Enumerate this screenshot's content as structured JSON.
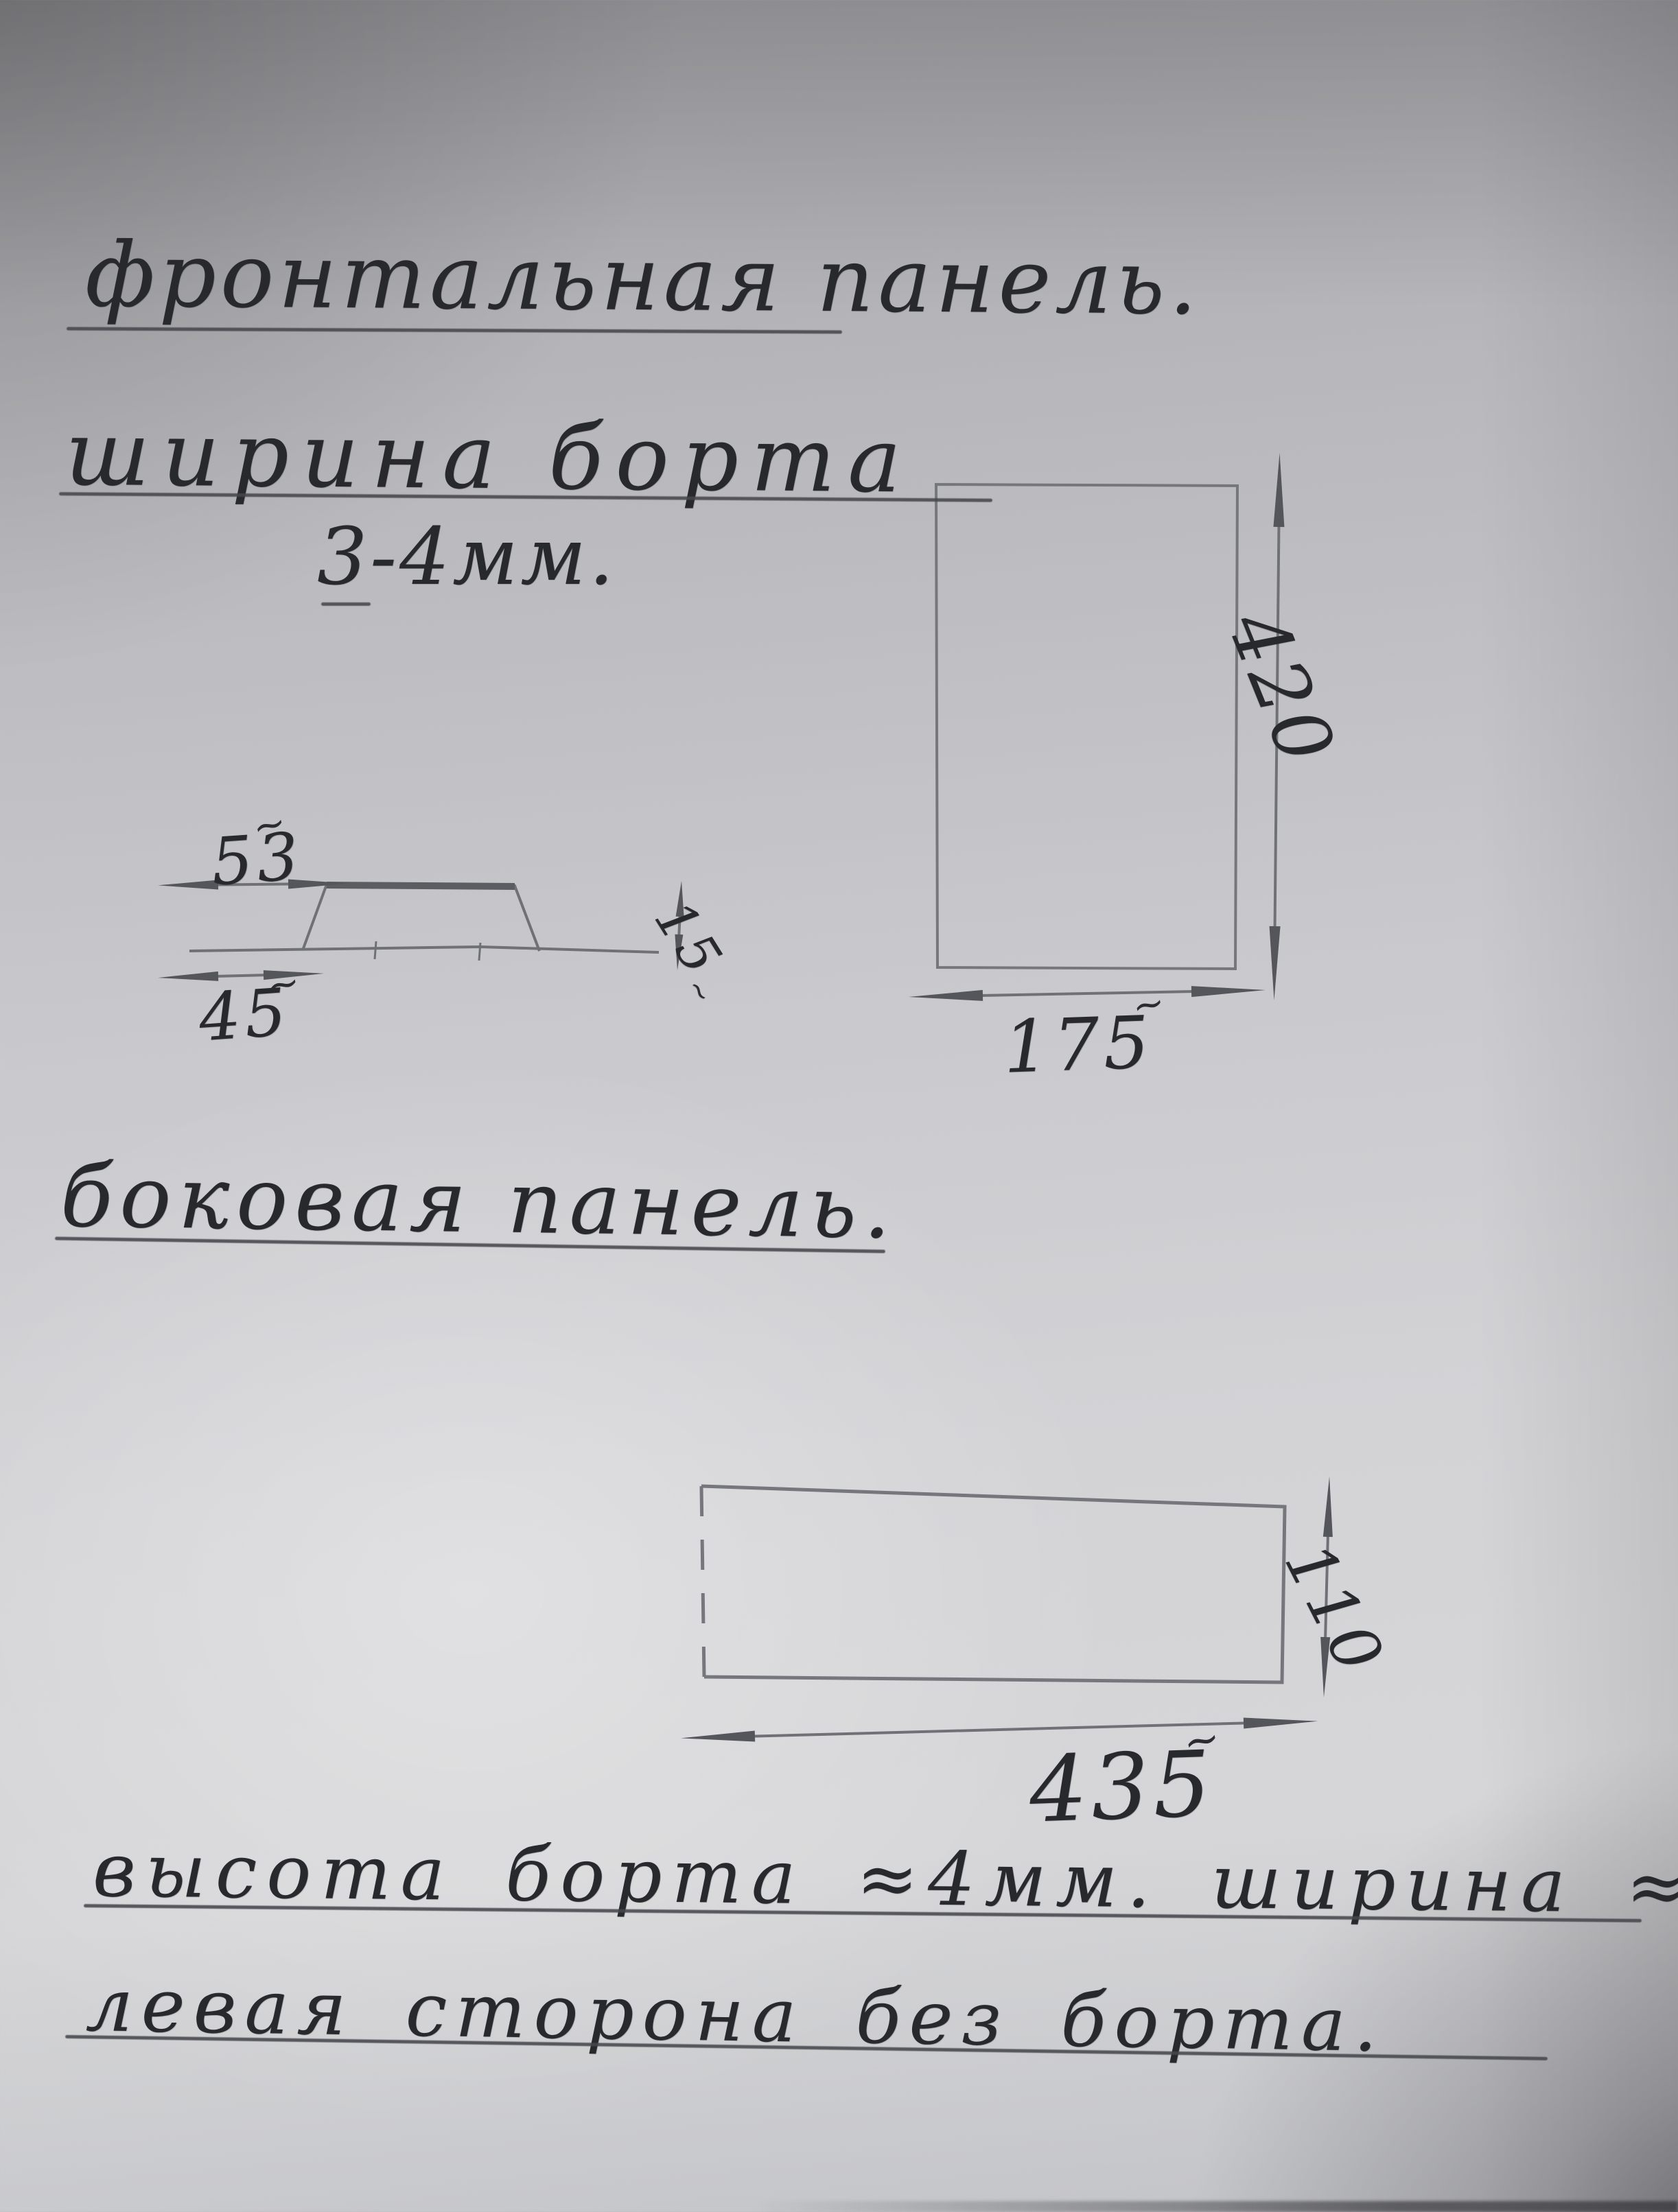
{
  "title": "фронтальная панель.",
  "marks": {
    "approx": "~"
  },
  "front_panel": {
    "heading": "ширина борта",
    "border_width_note": "3-4мм.",
    "profile": {
      "top_width": "53",
      "base_width": "45",
      "height": "15"
    },
    "height": "420",
    "width": "175"
  },
  "side_panel": {
    "heading": "боковая панель.",
    "height": "110",
    "width": "435"
  },
  "notes": {
    "line1": "высота борта ≈4мм. ширина ≈3мм.",
    "line2": "левая сторона без борта."
  }
}
